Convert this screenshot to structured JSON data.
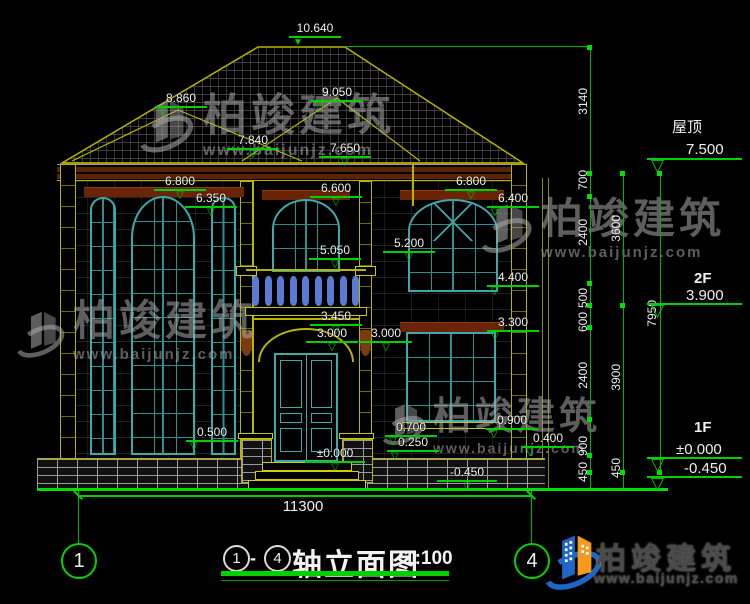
{
  "colors": {
    "background": "#000000",
    "dim_green": "#00cf00",
    "outline_yellow": "#b5b500",
    "window_teal": "#3fa8a8",
    "band_brown": "#6b2408",
    "baluster_blue": "#5b79d6",
    "logo_blue": "#1e66c8",
    "logo_orange": "#f59a1a"
  },
  "dims": {
    "top_ridge": "10.640",
    "roof_left": "8.860",
    "roof_mid": "9.050",
    "roof_low_left": "7.840",
    "roof_low_mid": "7.650",
    "eave_left": "6.800",
    "win_left": "6.350",
    "win_center": "6.600",
    "eave_right": "6.800",
    "win_right_head": "6.400",
    "balcony_top": "5.050",
    "win_right_mid": "5.200",
    "win_right_sill": "4.400",
    "balcony_band": "3.450",
    "door_head_left": "3.000",
    "door_head_right": "3.000",
    "band_right": "3.300",
    "base_left": "0.500",
    "porch_upper": "0.700",
    "porch_lower": "0.250",
    "sill_right": "0.900",
    "spout": "0.400",
    "floor_zero": "±0.000",
    "ground_neg": "-0.450",
    "total_width": "11300"
  },
  "chains": {
    "a": [
      "3140",
      "700",
      "2400",
      "500",
      "600",
      "2400",
      "900",
      "450"
    ],
    "b": [
      "3600",
      "3900",
      "450"
    ],
    "c": [
      "7950"
    ]
  },
  "levels": {
    "roof_label": "屋顶",
    "roof_value": "7.500",
    "f2_label": "2F",
    "f2_value": "3.900",
    "f1_label": "1F",
    "f1_zero": "±0.000",
    "f1_neg": "-0.450"
  },
  "axis": {
    "left": "1",
    "right": "4"
  },
  "title": {
    "n1": "1",
    "sep": "-",
    "n2": "4",
    "text": "轴立面图",
    "scale": "1:100"
  },
  "watermark": {
    "name": "柏竣建筑",
    "url": "www.baijunjz.com"
  },
  "brand": {
    "name": "柏竣建筑",
    "url": "www.baijunjz.com"
  }
}
